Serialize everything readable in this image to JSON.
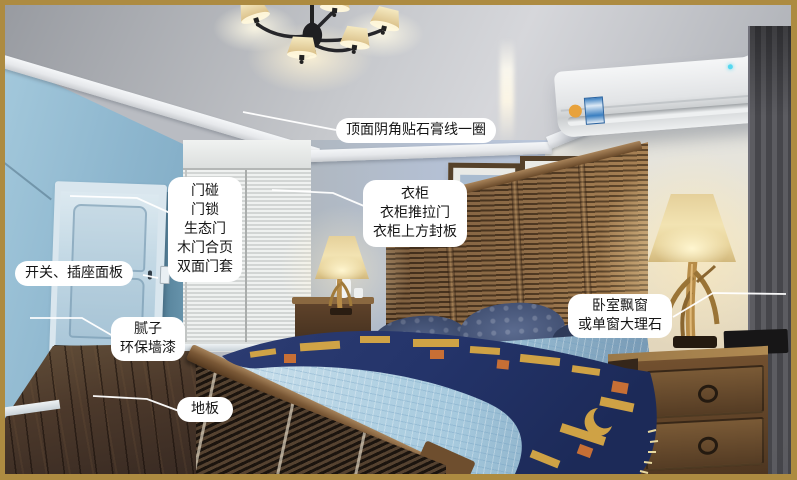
{
  "frame": {
    "border_color": "#ad8b41",
    "callout_bg": "#ffffff",
    "callout_text_color": "#151515",
    "callout_line_color": "#ffffff"
  },
  "callouts": {
    "ceiling": {
      "text": "顶面阴角贴石膏线一圈"
    },
    "door": {
      "lines": [
        "门碰",
        "门锁",
        "生态门",
        "木门合页",
        "双面门套"
      ]
    },
    "switch": {
      "text": "开关、插座面板"
    },
    "wall_paint": {
      "lines": [
        "腻子",
        "环保墙漆"
      ]
    },
    "floor": {
      "text": "地板"
    },
    "wardrobe": {
      "lines": [
        "衣柜",
        "衣柜推拉门",
        "衣柜上方封板"
      ]
    },
    "bay_window": {
      "lines": [
        "卧室飘窗",
        "或单窗大理石"
      ]
    }
  }
}
